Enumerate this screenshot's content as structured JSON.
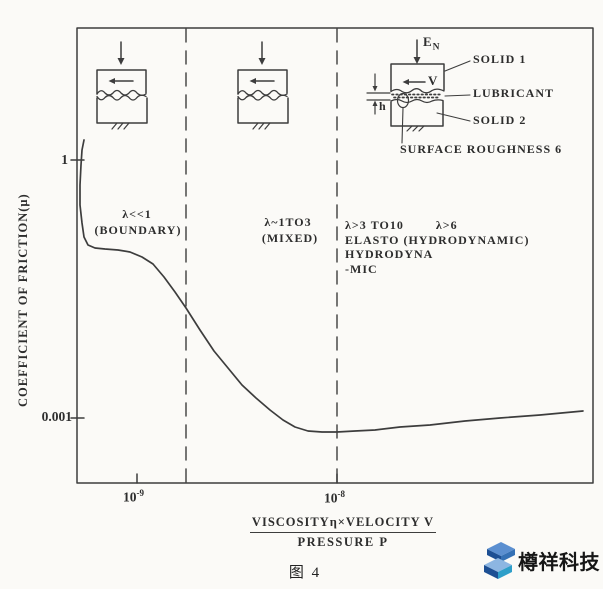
{
  "figure_caption": "图 4",
  "watermark": {
    "text": "樽祥科技",
    "logo_dark": "#1d4f93",
    "logo_mid": "#3571b5",
    "logo_light": "#8db6e2"
  },
  "y_axis": {
    "label": "COEFFICIENT OF FRICTION(μ)",
    "tick_top": "1",
    "tick_bottom": "0.001"
  },
  "x_axis": {
    "tick1_base": "10",
    "tick1_exp": "-9",
    "tick2_base": "10",
    "tick2_exp": "-8",
    "title_numerator": "VISCOSITYη×VELOCITY V",
    "title_denominator": "PRESSURE P"
  },
  "regions": {
    "boundary": {
      "line1": "λ<<1",
      "line2": "(BOUNDARY)"
    },
    "mixed": {
      "line1": "λ~1TO3",
      "line2": "(MIXED)"
    },
    "ehl": {
      "col1": "λ>3 TO10",
      "col2": "λ>6",
      "line2": "ELASTO (HYDRODYNAMIC)",
      "line3": "HYDRODYNA",
      "line4": "-MIC"
    }
  },
  "inset": {
    "force_base": "E",
    "force_sub": "N",
    "velocity": "V",
    "film_thickness": "h",
    "solid1": "SOLID 1",
    "lubricant": "LUBRICANT",
    "solid2": "SOLID 2",
    "roughness": "SURFACE ROUGHNESS 6"
  },
  "chart_data": {
    "type": "line",
    "title": "Stribeck curve — friction regimes of lubrication (图 4)",
    "xlabel": "VISCOSITYη×VELOCITY V / PRESSURE P",
    "ylabel": "COEFFICIENT OF FRICTION(μ)",
    "x_scale": "log",
    "y_scale": "log",
    "x_ticks": [
      1e-09,
      1e-08
    ],
    "y_ticks": [
      1,
      0.001
    ],
    "grid": false,
    "regimes": [
      {
        "label": "λ<<1 (BOUNDARY)",
        "x_to": 1.8e-09
      },
      {
        "label": "λ~1TO3 (MIXED)",
        "x_to": 1e-08
      },
      {
        "label": "λ>3 TO10 ELASTOHYDRODYNA-MIC; λ>6 (HYDRODYNAMIC)",
        "x_to": null
      }
    ],
    "series": [
      {
        "name": "coefficient of friction μ",
        "points": [
          [
            5e-10,
            2.0
          ],
          [
            5.2e-10,
            0.23
          ],
          [
            5.6e-10,
            0.105
          ],
          [
            7.3e-10,
            0.095
          ],
          [
            1e-09,
            0.08
          ],
          [
            1.35e-09,
            0.045
          ],
          [
            1.75e-09,
            0.019
          ],
          [
            2.4e-09,
            0.006
          ],
          [
            3.5e-09,
            0.0022
          ],
          [
            4.9e-09,
            0.0011
          ],
          [
            6.5e-09,
            0.0007
          ],
          [
            1e-08,
            0.00066
          ],
          [
            2.1e-08,
            0.00075
          ],
          [
            4.6e-08,
            0.0009
          ],
          [
            1e-07,
            0.00105
          ],
          [
            1.7e-07,
            0.0012
          ]
        ]
      }
    ],
    "regime_boundary_px": [
      186,
      337
    ],
    "px_polyline": [
      [
        84,
        140
      ],
      [
        82,
        150
      ],
      [
        81,
        165
      ],
      [
        80,
        185
      ],
      [
        80,
        205
      ],
      [
        82,
        223
      ],
      [
        84,
        237
      ],
      [
        88,
        245
      ],
      [
        95,
        248
      ],
      [
        105,
        249
      ],
      [
        118,
        250
      ],
      [
        130,
        252
      ],
      [
        142,
        257
      ],
      [
        153,
        264
      ],
      [
        164,
        277
      ],
      [
        175,
        292
      ],
      [
        186,
        308
      ],
      [
        200,
        330
      ],
      [
        214,
        351
      ],
      [
        228,
        368
      ],
      [
        242,
        385
      ],
      [
        256,
        398
      ],
      [
        270,
        410
      ],
      [
        283,
        420
      ],
      [
        295,
        427
      ],
      [
        308,
        431
      ],
      [
        322,
        432
      ],
      [
        337,
        432
      ],
      [
        355,
        431
      ],
      [
        375,
        430
      ],
      [
        400,
        427
      ],
      [
        430,
        425
      ],
      [
        465,
        421
      ],
      [
        500,
        418
      ],
      [
        540,
        415
      ],
      [
        583,
        411
      ]
    ]
  }
}
